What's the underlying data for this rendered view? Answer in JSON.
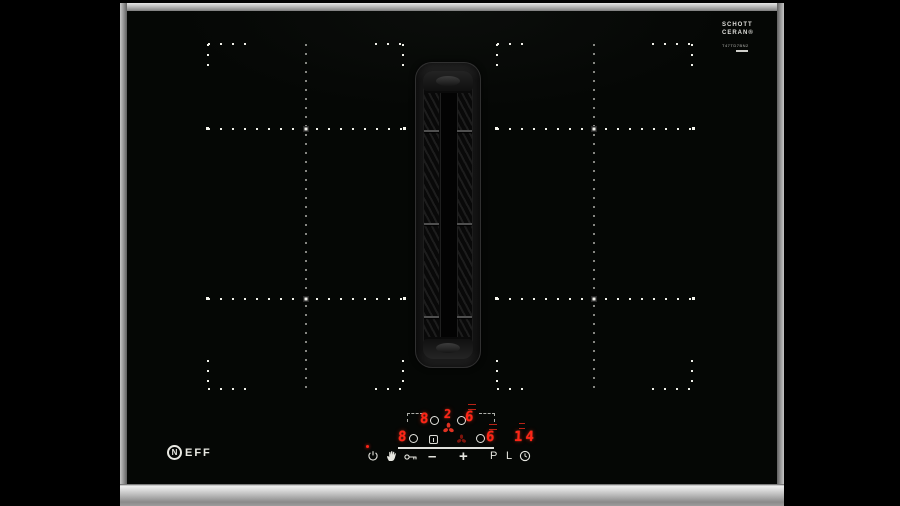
{
  "product": {
    "brand_emblem_letter": "N",
    "brand_rest": "EFF",
    "glass_brand_line1": "SCHOTT",
    "glass_brand_line2": "CERAN®",
    "glass_small_print": "T47TD7BN2"
  },
  "display": {
    "back_left_level": "8",
    "back_right_level": "6",
    "front_left_level": "8",
    "front_right_level": "6",
    "fan_level": "2",
    "timer_value": "14"
  },
  "touch_labels": {
    "minus": "–",
    "plus": "+",
    "power_boost": "P",
    "lock": "L"
  },
  "icons": {
    "power": "power-icon",
    "wipe_protection": "hand-icon",
    "child_lock": "key-icon",
    "timer": "clock-icon",
    "fan_display": "fan-icon",
    "vent_zone": "vent-fan-icon",
    "zone_select": "zone-select-ring"
  },
  "colors": {
    "background": "#000000",
    "glass": "#050705",
    "led_red": "#ff2416",
    "dim_red": "#7d140c",
    "print_white": "#e6e6e0",
    "steel": "#b5b5b5"
  }
}
